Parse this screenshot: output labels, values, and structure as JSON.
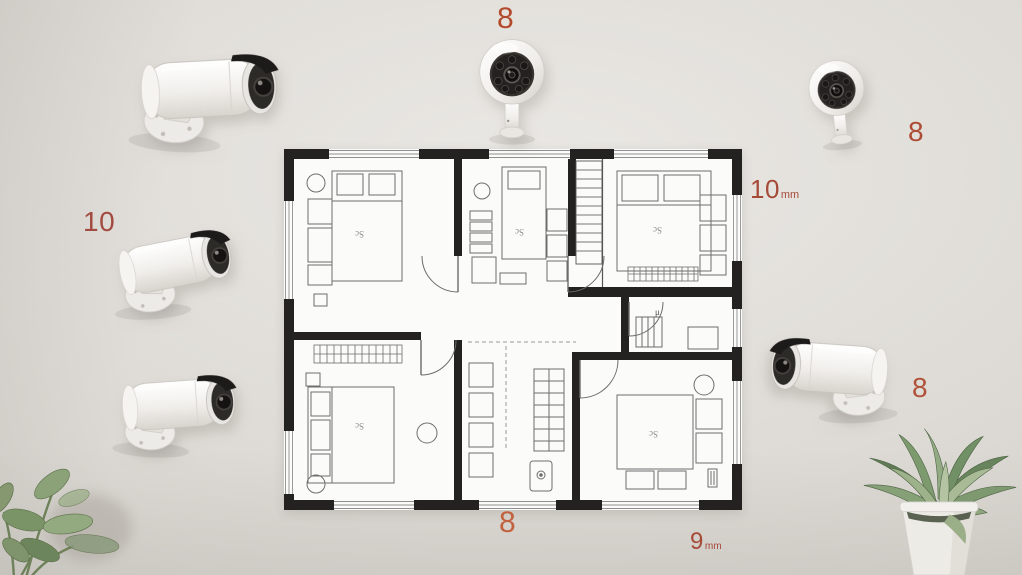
{
  "scene": {
    "wall_color": "#d9d6d1"
  },
  "labels": {
    "top_center": {
      "text": "8",
      "color": "#b34a2d"
    },
    "top_right": {
      "text": "8",
      "color": "#ad4b35"
    },
    "left": {
      "text": "10",
      "color": "#a34b40"
    },
    "right": {
      "text": "8",
      "color": "#b0523a"
    },
    "bottom_center": {
      "text": "8",
      "color": "#c2623e"
    },
    "dim_top_right": {
      "value": "10",
      "unit": "mm",
      "color": "#a64a38"
    },
    "dim_bottom": {
      "value": "9",
      "unit": "mm",
      "color": "#a64a38"
    }
  },
  "floor_plan": {
    "room_labels": [
      "Sc",
      "Sc",
      "Sc",
      "Sc",
      "Sc"
    ],
    "stair_label": "μ",
    "wall_color": "#232220",
    "floor_color": "#fbfbfa"
  },
  "cameras": [
    {
      "name": "camera-top-left",
      "type": "bullet",
      "facing": "right"
    },
    {
      "name": "camera-top-center",
      "type": "front",
      "facing": "forward"
    },
    {
      "name": "camera-top-right",
      "type": "front",
      "facing": "forward"
    },
    {
      "name": "camera-left-middle",
      "type": "bullet",
      "facing": "right"
    },
    {
      "name": "camera-left-bottom",
      "type": "bullet",
      "facing": "right"
    },
    {
      "name": "camera-right-bottom",
      "type": "bullet",
      "facing": "left"
    }
  ],
  "plants": [
    {
      "name": "plant-bottom-left"
    },
    {
      "name": "plant-bottom-right"
    }
  ]
}
